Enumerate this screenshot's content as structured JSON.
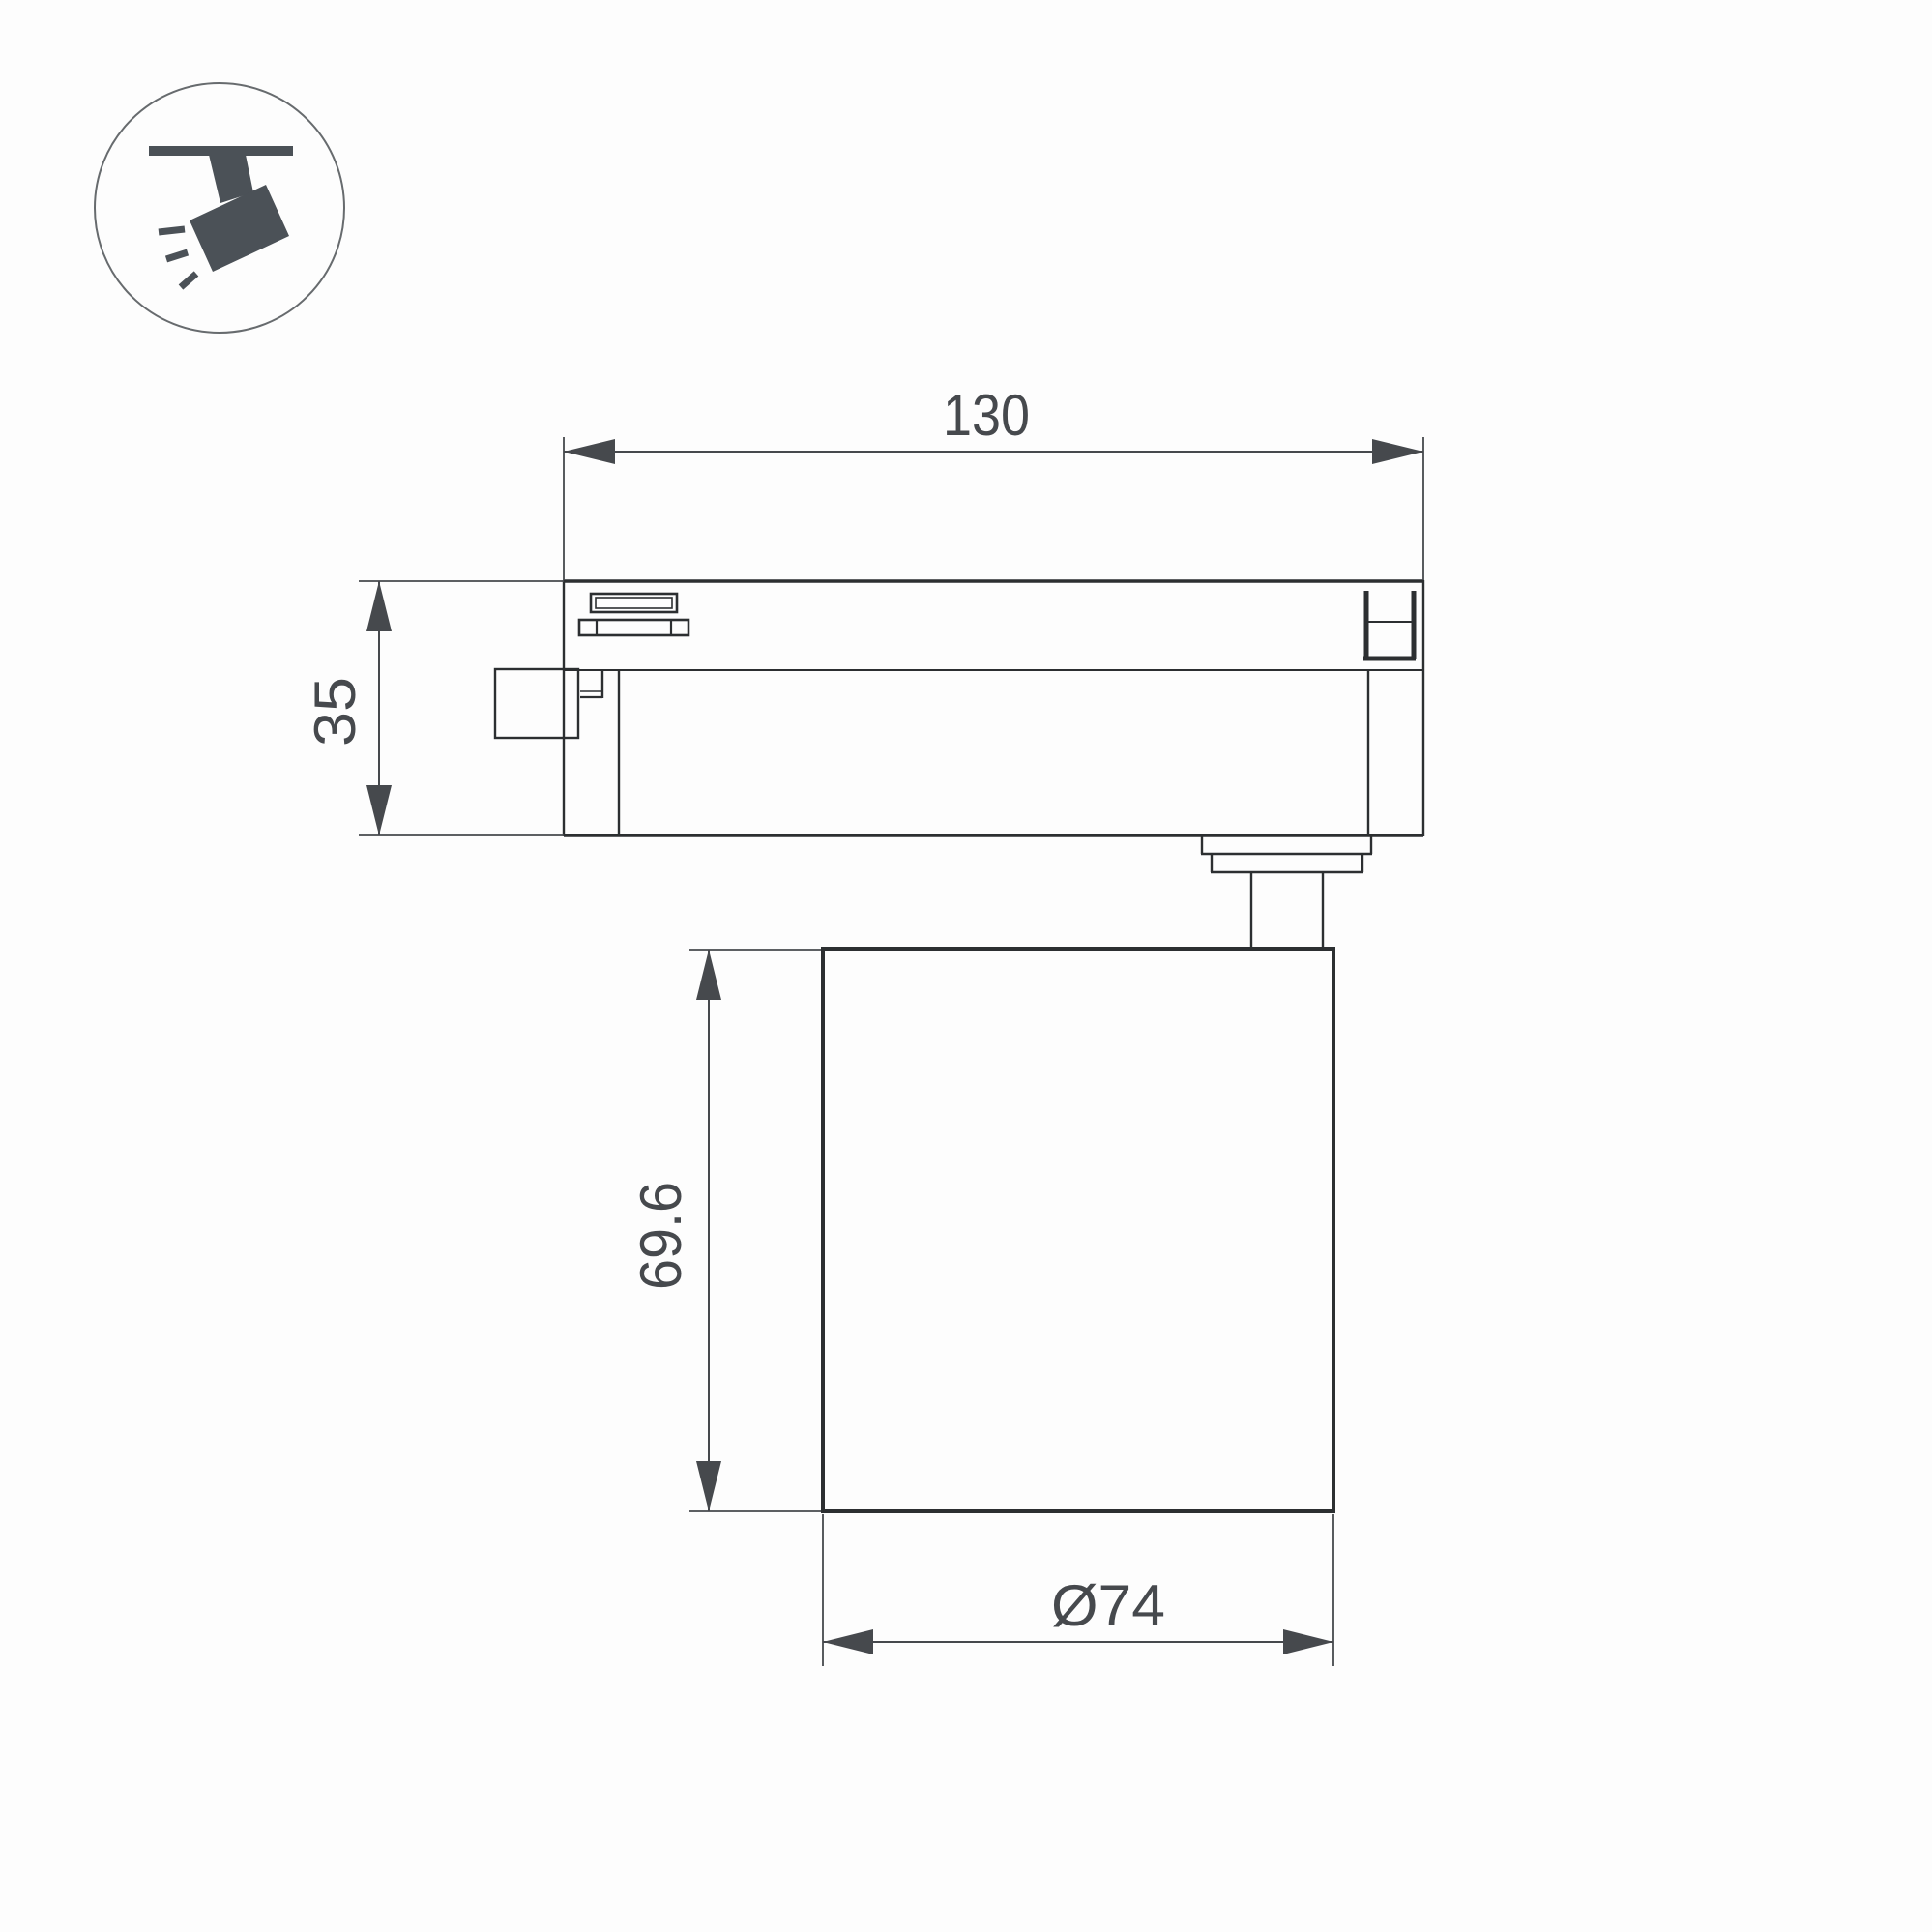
{
  "page": {
    "background_color": "#fdfdfd",
    "type": "technical-dimension-drawing"
  },
  "colors": {
    "outline_thick": "#2c2f31",
    "outline_thin": "#3a3d40",
    "dimension": "#46494d",
    "icon_glyph": "#4b5157",
    "icon_circle_stroke": "#676b6e"
  },
  "icon": {
    "name": "track-spotlight-icon"
  },
  "dims": {
    "d130": {
      "label": "130",
      "orientation": "horizontal",
      "location": "top"
    },
    "d35": {
      "label": "35",
      "orientation": "vertical",
      "location": "left"
    },
    "d696": {
      "label": "69.6",
      "orientation": "vertical",
      "location": "middle-left"
    },
    "d74": {
      "label": "Ø74",
      "orientation": "horizontal",
      "location": "bottom"
    }
  }
}
